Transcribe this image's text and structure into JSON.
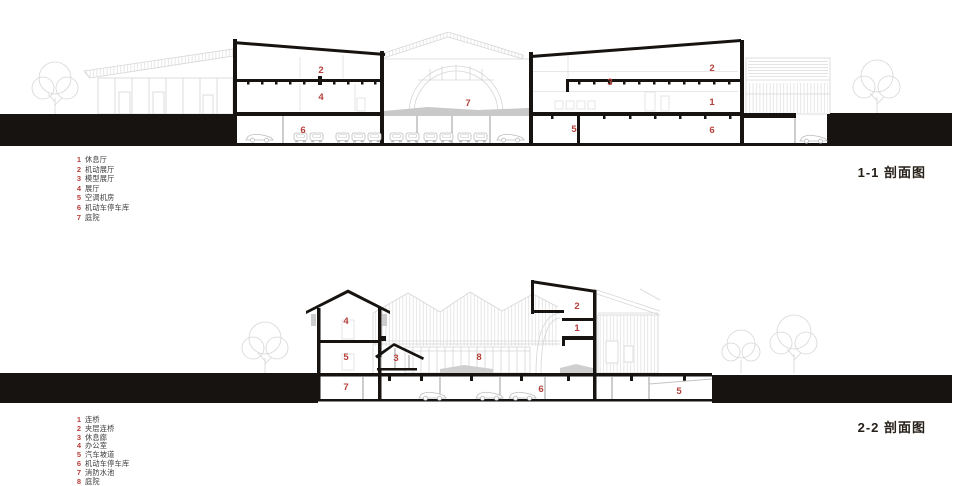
{
  "sheet": {
    "type": "architectural-section-sheet",
    "background": "#ffffff"
  },
  "colors": {
    "accent_red": "#b5413b",
    "ink": "#161310",
    "background_line_gray": "#d6d6d6",
    "ground_gray": "#c9c9c9",
    "legend_text": "#3d3d3d"
  },
  "sections": [
    {
      "id": "1-1",
      "title": "1-1 剖面图",
      "legend": [
        {
          "num": "1",
          "label": "休息厅"
        },
        {
          "num": "2",
          "label": "机动展厅"
        },
        {
          "num": "3",
          "label": "模型展厅"
        },
        {
          "num": "4",
          "label": "展厅"
        },
        {
          "num": "5",
          "label": "空调机房"
        },
        {
          "num": "6",
          "label": "机动车停车库"
        },
        {
          "num": "7",
          "label": "庭院"
        }
      ],
      "drawing_labels": [
        {
          "num": "2",
          "x": 321,
          "y": 71
        },
        {
          "num": "4",
          "x": 321,
          "y": 98
        },
        {
          "num": "6",
          "x": 303,
          "y": 131
        },
        {
          "num": "7",
          "x": 468,
          "y": 104
        },
        {
          "num": "3",
          "x": 610,
          "y": 83
        },
        {
          "num": "2",
          "x": 712,
          "y": 69
        },
        {
          "num": "1",
          "x": 712,
          "y": 103
        },
        {
          "num": "5",
          "x": 574,
          "y": 130
        },
        {
          "num": "6",
          "x": 712,
          "y": 131
        }
      ]
    },
    {
      "id": "2-2",
      "title": "2-2 剖面图",
      "legend": [
        {
          "num": "1",
          "label": "连桥"
        },
        {
          "num": "2",
          "label": "夹层连桥"
        },
        {
          "num": "3",
          "label": "休息廊"
        },
        {
          "num": "4",
          "label": "办公室"
        },
        {
          "num": "5",
          "label": "汽车坡道"
        },
        {
          "num": "6",
          "label": "机动车停车库"
        },
        {
          "num": "7",
          "label": "消防水池"
        },
        {
          "num": "8",
          "label": "庭院"
        }
      ],
      "drawing_labels": [
        {
          "num": "4",
          "x": 346,
          "y": 322
        },
        {
          "num": "5",
          "x": 346,
          "y": 358
        },
        {
          "num": "7",
          "x": 346,
          "y": 388
        },
        {
          "num": "3",
          "x": 396,
          "y": 359
        },
        {
          "num": "8",
          "x": 479,
          "y": 358
        },
        {
          "num": "2",
          "x": 577,
          "y": 307
        },
        {
          "num": "1",
          "x": 577,
          "y": 329
        },
        {
          "num": "6",
          "x": 541,
          "y": 390
        },
        {
          "num": "5",
          "x": 679,
          "y": 392
        }
      ]
    }
  ]
}
